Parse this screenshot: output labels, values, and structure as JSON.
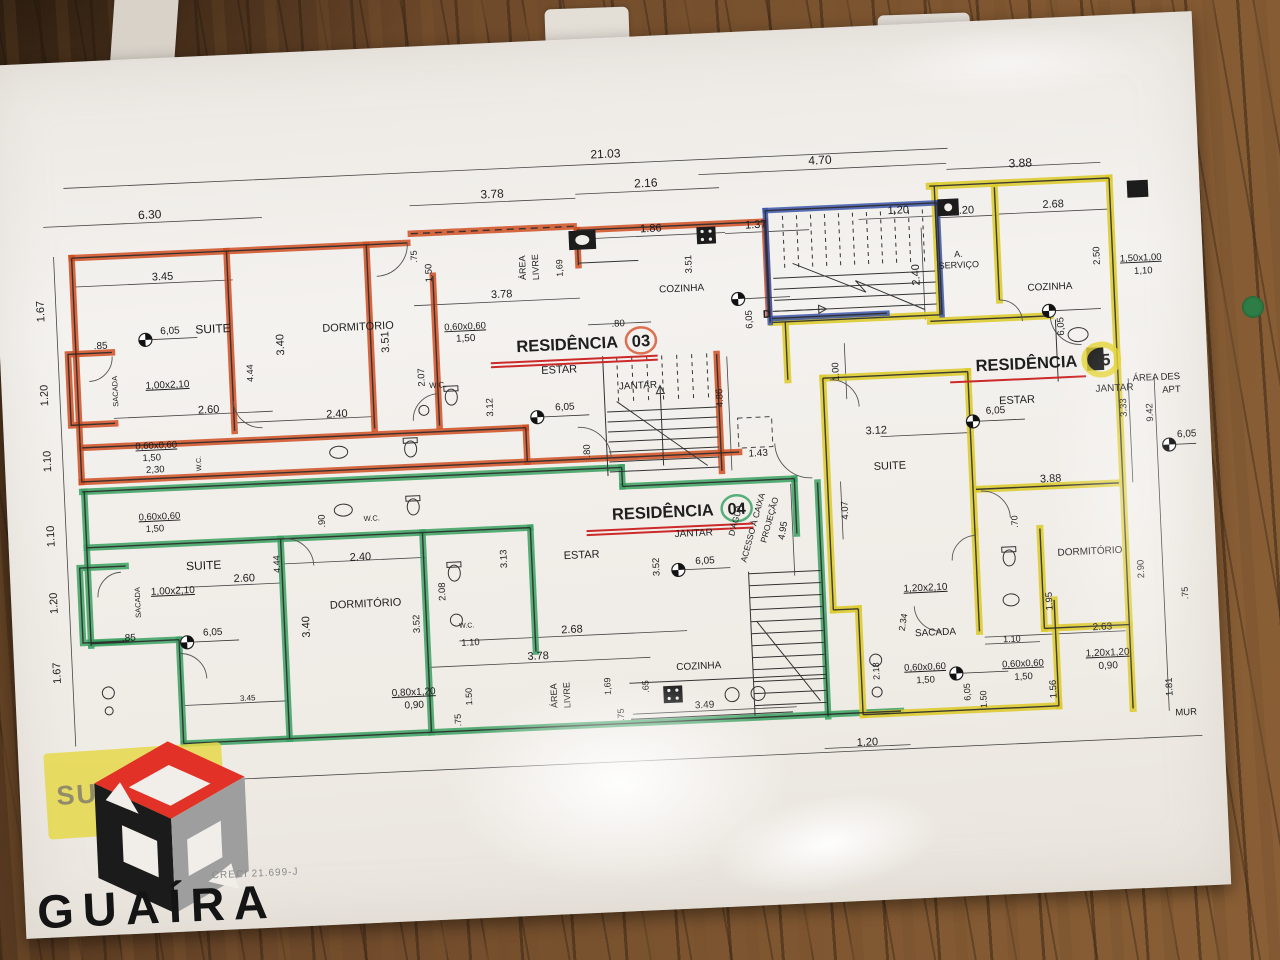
{
  "colors": {
    "wood": "#6d482a",
    "sheet": "#f1eeea",
    "ink": "#2b2b2b",
    "dim": "#444444",
    "res03_highlight": "#cf4e22",
    "res04_highlight": "#3aa060",
    "res05_highlight": "#ddcb30",
    "stairs_highlight": "#3c55a8",
    "underline_red": "#cc2a2a",
    "stamp_yellow": "#e6d84a",
    "logo_red": "#e23127",
    "logo_black": "#1b1b1b",
    "logo_gray": "#9e9e9e",
    "sticker_green": "#2e7d46"
  },
  "stamp": {
    "text": "SUPERIOR"
  },
  "logo": {
    "brand": "GUAÍRA",
    "creci": "CRECI 21.699-J"
  },
  "plan": {
    "residences": [
      {
        "label": "RESIDÊNCIA",
        "num": "03",
        "lx": 602,
        "ly": 276,
        "nx": 625,
        "ny": 276,
        "ex": 625,
        "ey": 270,
        "rx": 15,
        "ry": 13,
        "sw": 2.5,
        "color": "#d4502a",
        "ux1": 474,
        "ux2": 641,
        "uy": 286,
        "un": 2
      },
      {
        "label": "RESIDÊNCIA",
        "num": "04",
        "lx": 690,
        "ly": 448,
        "nx": 713,
        "ny": 448,
        "ex": 713,
        "ey": 442,
        "rx": 15,
        "ry": 13,
        "sw": 2.5,
        "color": "#2f9e5f",
        "ux1": 562,
        "ux2": 729,
        "uy": 458,
        "un": 2
      },
      {
        "label": "RESIDÊNCIA",
        "num": "05",
        "lx": 1060,
        "ly": 316,
        "nx": 1084,
        "ny": 316,
        "ex": 1084,
        "ey": 310,
        "rx": 17,
        "ry": 15,
        "sw": 6,
        "color": "#e3d22a",
        "ux1": 932,
        "ux2": 1068,
        "uy": 326,
        "un": 1
      }
    ],
    "levels": [
      {
        "x": 130,
        "y": 247
      },
      {
        "x": 518,
        "y": 342
      },
      {
        "x": 724,
        "y": 233
      },
      {
        "x": 1034,
        "y": 259
      },
      {
        "x": 158,
        "y": 551
      },
      {
        "x": 652,
        "y": 501
      },
      {
        "x": 1148,
        "y": 398
      },
      {
        "x": 925,
        "y": 617
      },
      {
        "x": 953,
        "y": 366
      }
    ],
    "texts": [
      {
        "t": "21.03",
        "x": 598,
        "y": 86,
        "s": 12
      },
      {
        "t": "4.70",
        "x": 812,
        "y": 102,
        "s": 12
      },
      {
        "t": "3.88",
        "x": 1012,
        "y": 114,
        "s": 12
      },
      {
        "t": "6.30",
        "x": 140,
        "y": 126,
        "s": 12
      },
      {
        "t": "3.78",
        "x": 483,
        "y": 121,
        "s": 12
      },
      {
        "t": "2.16",
        "x": 637,
        "y": 117,
        "s": 12
      },
      {
        "t": "1.86",
        "x": 640,
        "y": 162
      },
      {
        "t": "1.37",
        "x": 745,
        "y": 163
      },
      {
        "t": "1.20",
        "x": 888,
        "y": 155
      },
      {
        "t": "1.20",
        "x": 953,
        "y": 158
      },
      {
        "t": "2.68",
        "x": 1043,
        "y": 156
      },
      {
        "t": "3.45",
        "x": 150,
        "y": 188
      },
      {
        "t": "3.78",
        "x": 488,
        "y": 221
      },
      {
        "t": "1.67",
        "x": 30,
        "y": 214,
        "r": -90
      },
      {
        "t": "1.20",
        "x": 30,
        "y": 298,
        "r": -90
      },
      {
        "t": "1.10",
        "x": 30,
        "y": 364,
        "r": -90
      },
      {
        "t": "1.10",
        "x": 30,
        "y": 439,
        "r": -90
      },
      {
        "t": "1.20",
        "x": 30,
        "y": 506,
        "r": -90
      },
      {
        "t": "1.67",
        "x": 30,
        "y": 576,
        "r": -90
      },
      {
        "t": ".85",
        "x": 85,
        "y": 254,
        "s": 10
      },
      {
        "t": ".85",
        "x": 100,
        "y": 547,
        "s": 10
      },
      {
        "t": "6,05",
        "x": 155,
        "y": 242,
        "s": 10,
        "n": "level-label"
      },
      {
        "t": "SUITE",
        "x": 198,
        "y": 243,
        "s": 12,
        "n": "room-label"
      },
      {
        "t": "DORMITÓRIO",
        "x": 343,
        "y": 247,
        "n": "room-label"
      },
      {
        "t": "3.40",
        "x": 268,
        "y": 258,
        "r": -90
      },
      {
        "t": "3.51",
        "x": 373,
        "y": 260,
        "r": -90
      },
      {
        "t": "4.44",
        "x": 236,
        "y": 285,
        "r": -90,
        "s": 9
      },
      {
        "t": "1,00x2,10",
        "x": 150,
        "y": 296,
        "s": 10,
        "u": 1,
        "n": "window-spec"
      },
      {
        "t": "2.60",
        "x": 190,
        "y": 323
      },
      {
        "t": "2.40",
        "x": 318,
        "y": 333
      },
      {
        "t": "SACADA",
        "x": 100,
        "y": 297,
        "r": -90,
        "s": 7.5,
        "n": "room-label"
      },
      {
        "t": "0,60x0,60",
        "x": 450,
        "y": 251,
        "s": 9.5,
        "u": 1,
        "n": "window-spec"
      },
      {
        "t": "1,50",
        "x": 450,
        "y": 263,
        "s": 10,
        "n": "window-spec"
      },
      {
        "t": ".75",
        "x": 405,
        "y": 176,
        "r": -90,
        "s": 9
      },
      {
        "t": "1.50",
        "x": 419,
        "y": 193,
        "r": -90,
        "s": 9.5
      },
      {
        "t": "2.07",
        "x": 407,
        "y": 297,
        "r": -90,
        "s": 9.5
      },
      {
        "t": "3.12",
        "x": 474,
        "y": 330,
        "r": -90,
        "s": 9.5
      },
      {
        "t": "W.C.",
        "x": 420,
        "y": 308,
        "s": 8,
        "n": "room-label"
      },
      {
        "t": "ÁREA",
        "x": 513,
        "y": 192,
        "r": -90,
        "s": 9,
        "n": "room-label"
      },
      {
        "t": "LIVRE",
        "x": 526,
        "y": 192,
        "r": -90,
        "s": 9,
        "n": "room-label"
      },
      {
        "t": "1,69",
        "x": 550,
        "y": 194,
        "r": -90,
        "s": 9
      },
      {
        "t": "3.51",
        "x": 679,
        "y": 196,
        "r": -90,
        "s": 9.5
      },
      {
        "t": "COZINHA",
        "x": 668,
        "y": 223,
        "s": 10,
        "n": "room-label"
      },
      {
        "t": "ESTAR",
        "x": 542,
        "y": 299,
        "s": 11,
        "n": "room-label"
      },
      {
        "t": "6,05",
        "x": 546,
        "y": 336,
        "s": 10,
        "n": "level-label"
      },
      {
        "t": "JANTAR",
        "x": 620,
        "y": 318,
        "s": 10,
        "n": "room-label"
      },
      {
        "t": ".80",
        "x": 603,
        "y": 255,
        "s": 9.5
      },
      {
        "t": ".80",
        "x": 569,
        "y": 378,
        "r": -90,
        "s": 9.5
      },
      {
        "t": "4.86",
        "x": 704,
        "y": 331,
        "r": -90,
        "s": 9.5
      },
      {
        "t": "1.43",
        "x": 737,
        "y": 391,
        "s": 10
      },
      {
        "t": "0,60x0,60",
        "x": 136,
        "y": 356,
        "s": 9.5,
        "u": 1,
        "n": "window-spec"
      },
      {
        "t": "1,50",
        "x": 131,
        "y": 368,
        "s": 9.5,
        "n": "window-spec"
      },
      {
        "t": "2,30",
        "x": 134,
        "y": 380,
        "s": 9.5,
        "n": "window-spec"
      },
      {
        "t": "W.C.",
        "x": 180,
        "y": 373,
        "r": -90,
        "s": 7,
        "n": "room-label"
      },
      {
        "t": "0,60x0,60",
        "x": 136,
        "y": 427,
        "s": 9.5,
        "u": 1,
        "n": "window-spec"
      },
      {
        "t": "1,50",
        "x": 131,
        "y": 439,
        "s": 9.5,
        "n": "window-spec"
      },
      {
        "t": "W.C.",
        "x": 348,
        "y": 438,
        "s": 7.5,
        "n": "room-label"
      },
      {
        "t": ".90",
        "x": 301,
        "y": 436,
        "r": -90,
        "s": 9.5
      },
      {
        "t": "SUITE",
        "x": 178,
        "y": 479,
        "s": 12,
        "n": "room-label"
      },
      {
        "t": "6,05",
        "x": 184,
        "y": 545,
        "s": 10,
        "n": "level-label"
      },
      {
        "t": "1,00x2,10",
        "x": 146,
        "y": 502,
        "s": 10,
        "u": 1,
        "n": "window-spec"
      },
      {
        "t": "2.60",
        "x": 218,
        "y": 493
      },
      {
        "t": "DORMITÓRIO",
        "x": 338,
        "y": 524,
        "n": "room-label"
      },
      {
        "t": "2.40",
        "x": 335,
        "y": 477
      },
      {
        "t": "3.40",
        "x": 281,
        "y": 541,
        "r": -90
      },
      {
        "t": "4.44",
        "x": 254,
        "y": 477,
        "r": -90,
        "s": 9
      },
      {
        "t": "3.52",
        "x": 391,
        "y": 543,
        "r": -90,
        "s": 9.5
      },
      {
        "t": "2.08",
        "x": 418,
        "y": 512,
        "r": -90,
        "s": 9.5
      },
      {
        "t": "W.C.",
        "x": 438,
        "y": 549,
        "s": 7,
        "n": "room-label"
      },
      {
        "t": "1.10",
        "x": 441,
        "y": 567,
        "s": 9.5
      },
      {
        "t": "3.13",
        "x": 481,
        "y": 482,
        "r": -90,
        "s": 9.5
      },
      {
        "t": "ESTAR",
        "x": 556,
        "y": 485,
        "s": 11,
        "n": "room-label"
      },
      {
        "t": "3.52",
        "x": 633,
        "y": 497,
        "r": -90,
        "s": 9.5
      },
      {
        "t": "6,05",
        "x": 679,
        "y": 496,
        "s": 10,
        "n": "level-label"
      },
      {
        "t": "JANTAR",
        "x": 669,
        "y": 468,
        "s": 10,
        "n": "room-label"
      },
      {
        "t": "2.68",
        "x": 543,
        "y": 559
      },
      {
        "t": "3.78",
        "x": 508,
        "y": 584
      },
      {
        "t": "ÁREA",
        "x": 525,
        "y": 621,
        "r": -90,
        "s": 9,
        "n": "room-label"
      },
      {
        "t": "LIVRE",
        "x": 538,
        "y": 621,
        "r": -90,
        "s": 9,
        "n": "room-label"
      },
      {
        "t": "1,69",
        "x": 579,
        "y": 614,
        "r": -90,
        "s": 9
      },
      {
        "t": ".65",
        "x": 617,
        "y": 616,
        "r": -90,
        "s": 9
      },
      {
        "t": ".75",
        "x": 591,
        "y": 643,
        "r": -90,
        "s": 9
      },
      {
        "t": ".75",
        "x": 428,
        "y": 641,
        "r": -90,
        "s": 9
      },
      {
        "t": "1.50",
        "x": 440,
        "y": 618,
        "r": -90,
        "s": 9
      },
      {
        "t": "COZINHA",
        "x": 668,
        "y": 601,
        "s": 10,
        "n": "room-label"
      },
      {
        "t": "3.49",
        "x": 672,
        "y": 640,
        "s": 10
      },
      {
        "t": "3.45",
        "x": 216,
        "y": 612,
        "s": 8
      },
      {
        "t": "0,80x1,20",
        "x": 382,
        "y": 614,
        "s": 10,
        "u": 1,
        "n": "window-spec"
      },
      {
        "t": "0,90",
        "x": 382,
        "y": 627,
        "s": 10,
        "n": "window-spec"
      },
      {
        "t": "SACADA",
        "x": 113,
        "y": 509,
        "r": -90,
        "s": 7.5,
        "n": "room-label"
      },
      {
        "t": "1.20",
        "x": 833,
        "y": 685,
        "s": 11
      },
      {
        "t": "4.95",
        "x": 761,
        "y": 467,
        "r": -78,
        "s": 9.5
      },
      {
        "t": "4.07",
        "x": 824,
        "y": 449,
        "r": -90,
        "s": 9.5
      },
      {
        "t": "PROJEÇÃO",
        "x": 748,
        "y": 456,
        "r": -72,
        "s": 8.5,
        "n": "annotation-label"
      },
      {
        "t": "ACESSO À CAIXA",
        "x": 731,
        "y": 463,
        "r": -72,
        "s": 8.5,
        "n": "annotation-label"
      },
      {
        "t": "D'ÁGUA",
        "x": 714,
        "y": 455,
        "r": -72,
        "s": 8.5,
        "n": "annotation-label"
      },
      {
        "t": "2.40",
        "x": 906,
        "y": 217,
        "r": -90
      },
      {
        "t": "1.00",
        "x": 821,
        "y": 310,
        "r": -90,
        "s": 9.5
      },
      {
        "t": "D",
        "x": 752,
        "y": 253,
        "b": 1,
        "n": "door-label"
      },
      {
        "t": "6,05",
        "x": 737,
        "y": 254,
        "r": -90,
        "s": 9.5,
        "n": "level-label"
      },
      {
        "t": "A.",
        "x": 946,
        "y": 201,
        "s": 9,
        "n": "room-label"
      },
      {
        "t": "SERVIÇO",
        "x": 946,
        "y": 212,
        "s": 9,
        "n": "room-label"
      },
      {
        "t": "COZINHA",
        "x": 1036,
        "y": 238,
        "s": 10,
        "n": "room-label"
      },
      {
        "t": "2.50",
        "x": 1087,
        "y": 206,
        "r": -90,
        "s": 9.5
      },
      {
        "t": "1,50x1,00",
        "x": 1128,
        "y": 213,
        "s": 9.5,
        "u": 1,
        "n": "window-spec"
      },
      {
        "t": "1,10",
        "x": 1130,
        "y": 226,
        "s": 9.5,
        "n": "window-spec"
      },
      {
        "t": "6,05",
        "x": 1048,
        "y": 275,
        "r": -90,
        "s": 9.5,
        "n": "level-label"
      },
      {
        "t": "ESTAR",
        "x": 998,
        "y": 350,
        "s": 11,
        "n": "room-label"
      },
      {
        "t": "6,05",
        "x": 976,
        "y": 359,
        "s": 10,
        "n": "level-label"
      },
      {
        "t": "JANTAR",
        "x": 1096,
        "y": 342,
        "s": 10,
        "n": "room-label"
      },
      {
        "t": "3.33",
        "x": 1107,
        "y": 359,
        "r": -90,
        "s": 9.5
      },
      {
        "t": "9.42",
        "x": 1133,
        "y": 365,
        "r": -90,
        "s": 9.5
      },
      {
        "t": "ÁREA DES",
        "x": 1162,
        "y": 333,
        "a": "end",
        "s": 9.5,
        "n": "annotation-label"
      },
      {
        "t": "APT",
        "x": 1162,
        "y": 346,
        "a": "end",
        "s": 9.5,
        "n": "annotation-label"
      },
      {
        "t": "6,05",
        "x": 1166,
        "y": 391,
        "s": 10,
        "n": "level-label"
      },
      {
        "t": "3.12",
        "x": 856,
        "y": 374,
        "s": 11
      },
      {
        "t": "SUITE",
        "x": 868,
        "y": 410,
        "s": 11,
        "n": "room-label"
      },
      {
        "t": "3.88",
        "x": 1028,
        "y": 430,
        "s": 11
      },
      {
        "t": ".70",
        "x": 993,
        "y": 468,
        "r": -90,
        "s": 9
      },
      {
        "t": "DORMITÓRIO",
        "x": 1064,
        "y": 504,
        "s": 10,
        "n": "room-label"
      },
      {
        "t": "2.90",
        "x": 1117,
        "y": 521,
        "r": -90,
        "s": 9.5
      },
      {
        "t": "1.95",
        "x": 1024,
        "y": 549,
        "r": -90,
        "s": 9.5
      },
      {
        "t": "2.63",
        "x": 1073,
        "y": 580,
        "s": 10
      },
      {
        "t": "1.10",
        "x": 982,
        "y": 588,
        "s": 9
      },
      {
        "t": "1,20x2,10",
        "x": 898,
        "y": 533,
        "s": 10,
        "u": 1,
        "n": "window-spec"
      },
      {
        "t": "SACADA",
        "x": 906,
        "y": 578,
        "s": 10,
        "n": "room-label"
      },
      {
        "t": "2.34",
        "x": 877,
        "y": 564,
        "r": -78,
        "s": 9
      },
      {
        "t": "2.18",
        "x": 848,
        "y": 611,
        "r": -90,
        "s": 9
      },
      {
        "t": "0,60x0,60",
        "x": 894,
        "y": 612,
        "s": 9.5,
        "u": 1,
        "n": "window-spec"
      },
      {
        "t": "1,50",
        "x": 894,
        "y": 625,
        "s": 9.5,
        "n": "window-spec"
      },
      {
        "t": "0,60x0,60",
        "x": 992,
        "y": 613,
        "s": 9.5,
        "u": 1,
        "n": "window-spec"
      },
      {
        "t": "1,50",
        "x": 992,
        "y": 626,
        "s": 9.5,
        "n": "window-spec"
      },
      {
        "t": "6,05",
        "x": 938,
        "y": 636,
        "r": -90,
        "s": 9,
        "n": "level-label"
      },
      {
        "t": "1.50",
        "x": 954,
        "y": 644,
        "r": -90,
        "s": 9
      },
      {
        "t": "1.56",
        "x": 1024,
        "y": 637,
        "r": -90,
        "s": 9.5
      },
      {
        "t": "1,20x1,20",
        "x": 1077,
        "y": 606,
        "s": 10,
        "u": 1,
        "n": "window-spec"
      },
      {
        "t": "0,90",
        "x": 1077,
        "y": 619,
        "s": 10,
        "n": "window-spec"
      },
      {
        "t": "1.81",
        "x": 1140,
        "y": 640,
        "r": -90,
        "s": 9.5
      },
      {
        "t": "MUR",
        "x": 1142,
        "y": 669,
        "a": "start",
        "s": 9.5,
        "n": "annotation-label"
      },
      {
        "t": ".75",
        "x": 1160,
        "y": 547,
        "r": -90,
        "s": 9
      }
    ]
  }
}
